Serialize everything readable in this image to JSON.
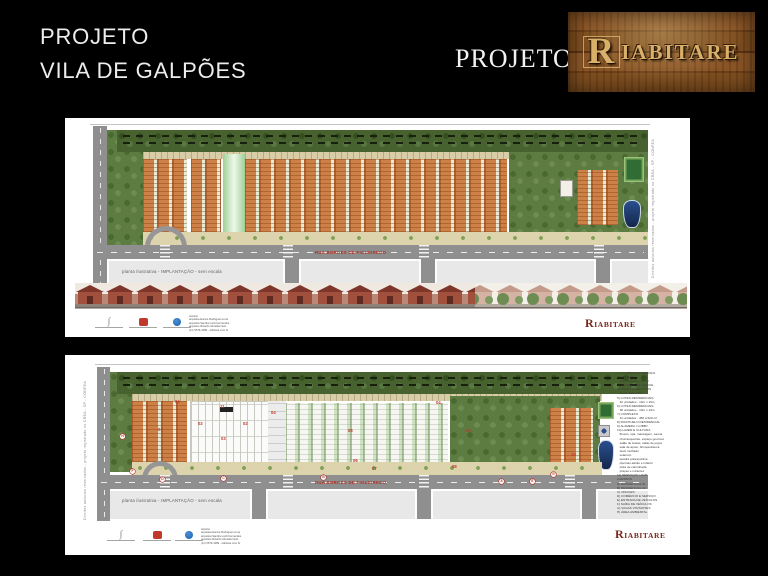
{
  "slide": {
    "title_line1": "PROJETO",
    "title_line2": "VILA DE GALPÕES",
    "brand_prefix": "PROJETO",
    "brand_initial": "R",
    "brand_rest": "IABITARE"
  },
  "panel1": {
    "street_label": "RUA BORGES DE FIGUEIREDO",
    "caption": "planta ilustrativa - IMPLANTAÇÃO - sem escala",
    "copyright": "Direitos autorais reservados  -  projeto registrado no CREA - SP - CONFEA",
    "brand_initial": "R",
    "brand_rest": "IABITARE",
    "credits": [
      "Autoria:",
      "arquiteta Eunice Rodrigues Lima",
      "arquiteta Sandra Lordi Fernandes",
      "arquiteto Ricardo Almeida Neto",
      "(11) 5579-3089  -  riabitare.com.br"
    ]
  },
  "panel2": {
    "street_label": "RUA BORGES DE FIGUEIREDO",
    "caption": "planta ilustrativa - IMPLANTAÇÃO - sem escala",
    "copyright": "Direitos autorais reservados  -  projeto registrado no CREA - SP - CONFEA",
    "brand_initial": "R",
    "brand_rest": "IABITARE",
    "credits": [
      "Autoria:",
      "arquiteta Eunice Rodrigues Lima",
      "arquiteta Sandra Lordi Fernandes",
      "arquiteto Ricardo Almeida Neto",
      "(11) 5579-3089  -  riabitare.com.br"
    ],
    "plan_labels": [
      {
        "t": "04",
        "x": 110,
        "y": 44
      },
      {
        "t": "01",
        "x": 93,
        "y": 72
      },
      {
        "t": "11",
        "x": 155,
        "y": 49
      },
      {
        "t": "02",
        "x": 133,
        "y": 66
      },
      {
        "t": "02",
        "x": 178,
        "y": 66
      },
      {
        "t": "03",
        "x": 156,
        "y": 81
      },
      {
        "t": "04",
        "x": 206,
        "y": 55
      },
      {
        "t": "04",
        "x": 371,
        "y": 45
      },
      {
        "t": "05",
        "x": 283,
        "y": 73
      },
      {
        "t": "06",
        "x": 288,
        "y": 103
      },
      {
        "t": "07",
        "x": 307,
        "y": 111
      },
      {
        "t": "08",
        "x": 387,
        "y": 109
      },
      {
        "t": "09",
        "x": 401,
        "y": 73
      },
      {
        "t": "10",
        "x": 506,
        "y": 97
      }
    ],
    "road_letters": [
      {
        "t": "H",
        "x": 55,
        "y": 79
      },
      {
        "t": "F",
        "x": 65,
        "y": 114
      },
      {
        "t": "D",
        "x": 95,
        "y": 122
      },
      {
        "t": "C",
        "x": 156,
        "y": 121
      },
      {
        "t": "B",
        "x": 256,
        "y": 120
      },
      {
        "t": "A",
        "x": 434,
        "y": 124
      },
      {
        "t": "E",
        "x": 465,
        "y": 124
      },
      {
        "t": "G",
        "x": 486,
        "y": 117
      }
    ],
    "legend": [
      "1) COMÉRCIO E SERVIÇO",
      "2) OFFICES",
      "   132 unidades - 45 m²",
      "3) RESIDENCIAL OFFICE",
      "4) VAGAS PARA AUTOS",
      "   residencial office",
      "5) LOTES RESIDENCIAIS",
      "   32 unidades - 10m x 19m",
      "6) LOTES RESIDENCIAIS",
      "   38 unidades - 10m x 19m",
      "7) COMPLEXO",
      "   11 unidades - 450 a 520 m²",
      "8) RIACHUELO RESIDENCIAL",
      "9) ALAMEDA / LOBBY",
      "10) LAZER E CULTURA",
      "   fitness, spa, massagem, sauna",
      "   churrasqueiras, espaço gourmet",
      "   salão de festas, salão de jogos",
      "   sala de apoio, brinquedoteca",
      "   deck molhado",
      "   solarium",
      "   quadra poliesportiva",
      "   piscinas adulto e infantil",
      "   pista de caminhada",
      "   praças e mirantes",
      "11) SERVIÇOS / ADM",
      "",
      "ACESSOS",
      "A) RESIDENCIAL 01",
      "B) RESIDENCIAL 02",
      "C) OFFICES",
      "D) COMÉRCIO E SERVIÇO",
      "E) ENTRADA DE VEÍCULOS",
      "F) SAÍDA DE VEÍCULOS",
      "G) VAGAS VISITANTES",
      "H) ÁREA AMBIENTAL"
    ]
  }
}
